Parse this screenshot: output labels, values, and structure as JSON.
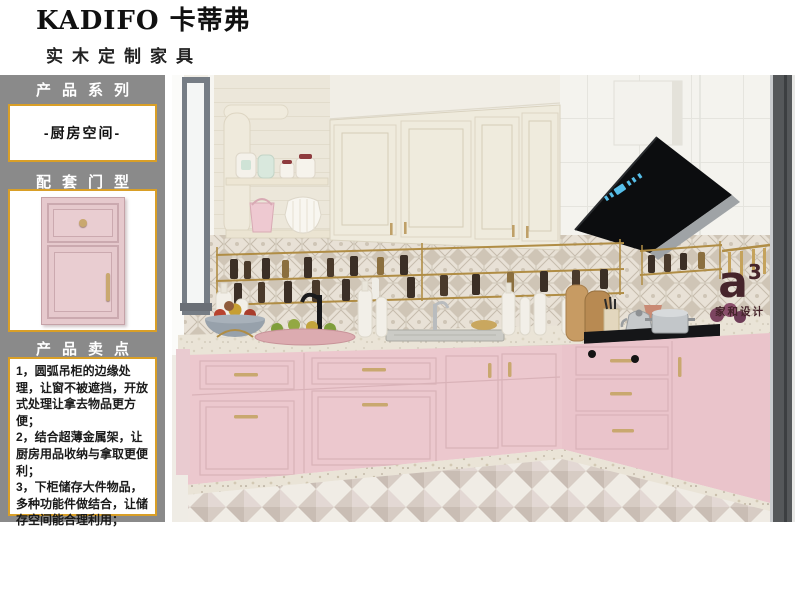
{
  "header": {
    "brand": "KADIFO 卡蒂弗",
    "subtitle": "实木定制家具"
  },
  "sidebar": {
    "sections": [
      {
        "title": "产品系列",
        "value": "-厨房空间-"
      },
      {
        "title": "配套门型"
      },
      {
        "title": "产品卖点",
        "points": [
          "1，圆弧吊柜的边缘处理，让窗不被遮挡，开放式处理让拿去物品更方便；",
          "2，结合超薄金属架，让厨房用品收纳与拿取更便利；",
          "3，下柜储存大件物品，多种功能件做结合，让储存空间能合理利用；"
        ]
      }
    ]
  },
  "watermark": {
    "symbol": "a",
    "sup": "3",
    "caption": "家和设计",
    "color": "#46242b"
  },
  "scene": {
    "description_labels": [],
    "colors": {
      "sidebar_gray": "#8a8a8a",
      "accent_gold_border": "#d99f27",
      "cabinet_pink": "#ecc8ce",
      "upper_cabinet_cream": "#efebdd",
      "hood_black": "#0c0d0f",
      "brass_rack": "#b08d45"
    }
  }
}
